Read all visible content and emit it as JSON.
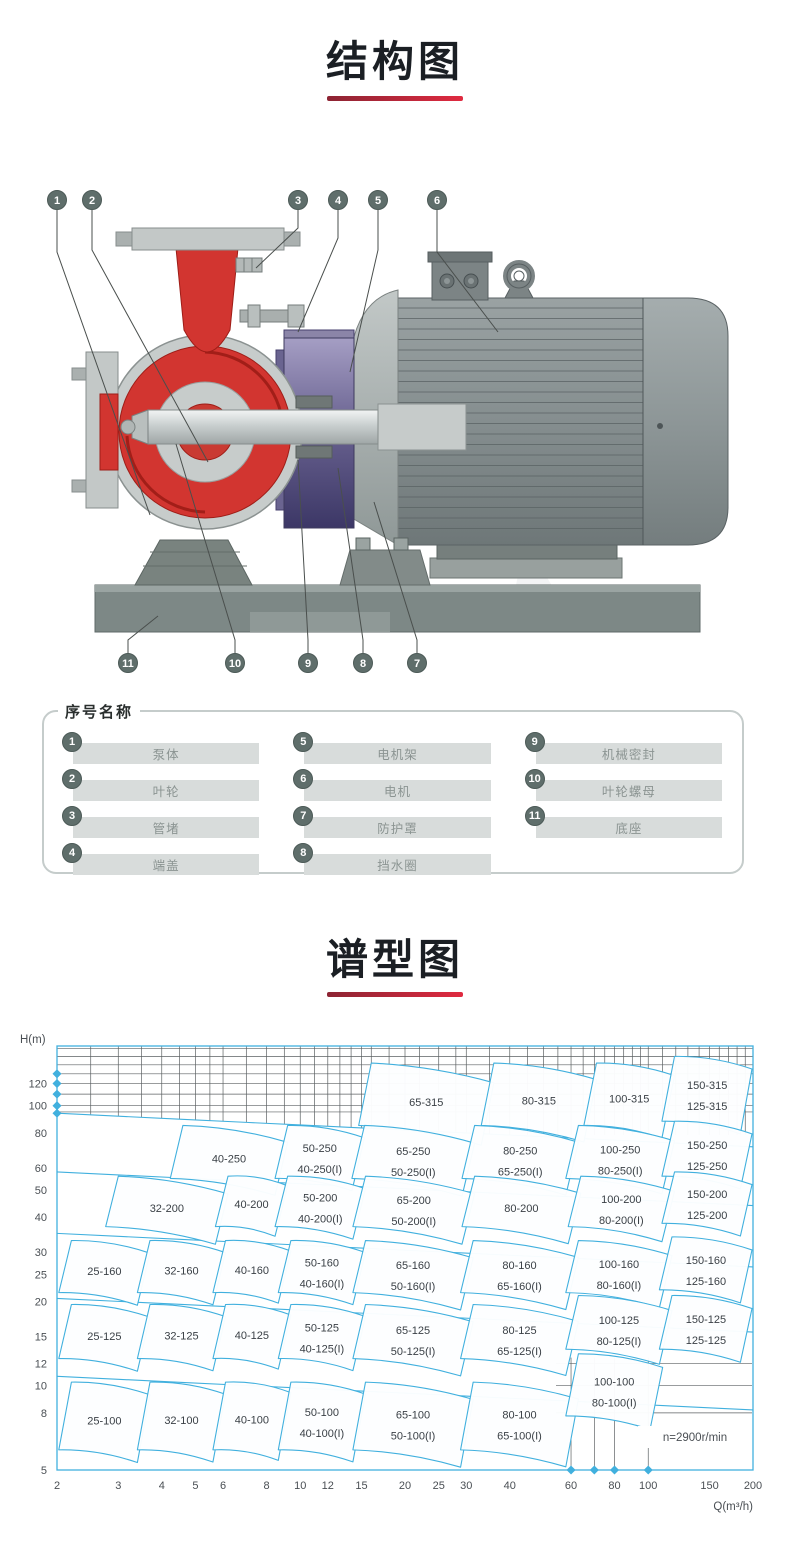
{
  "structure": {
    "title": "结构图",
    "underline_color": "#d8243c",
    "callouts_top": [
      "1",
      "2",
      "3",
      "4",
      "5",
      "6"
    ],
    "callouts_bottom": [
      "11",
      "10",
      "9",
      "8",
      "7"
    ],
    "legend": {
      "title": "序号名称",
      "items": [
        {
          "no": "1",
          "name": "泵体"
        },
        {
          "no": "2",
          "name": "叶轮"
        },
        {
          "no": "3",
          "name": "管堵"
        },
        {
          "no": "4",
          "name": "端盖"
        },
        {
          "no": "5",
          "name": "电机架"
        },
        {
          "no": "6",
          "name": "电机"
        },
        {
          "no": "7",
          "name": "防护罩"
        },
        {
          "no": "8",
          "name": "挡水圈"
        },
        {
          "no": "9",
          "name": "机械密封"
        },
        {
          "no": "10",
          "name": "叶轮螺母"
        },
        {
          "no": "11",
          "name": "底座"
        }
      ]
    }
  },
  "spectrum": {
    "title": "谱型图"
  },
  "chart_data": {
    "type": "region-map",
    "title": "谱型图",
    "x_axis_label": "Q(m³/h)",
    "y_axis_label": "H(m)",
    "x_scale": "log",
    "y_scale": "log",
    "x_range": [
      2,
      200
    ],
    "y_range": [
      5,
      165
    ],
    "x_ticks": [
      2,
      3,
      4,
      5,
      6,
      8,
      10,
      12,
      15,
      20,
      25,
      30,
      40,
      60,
      80,
      100,
      150,
      200
    ],
    "y_ticks": [
      5,
      8,
      10,
      12,
      15,
      20,
      25,
      30,
      40,
      50,
      60,
      80,
      100,
      120
    ],
    "annotation": "n=2900r/min",
    "accent_color": "#41b0de",
    "grid_color": "#5c6163",
    "regions": [
      {
        "labels": [
          "65-315"
        ],
        "q": [
          16,
          36
        ],
        "h": [
          85,
          142
        ]
      },
      {
        "labels": [
          "80-315"
        ],
        "q": [
          36,
          71
        ],
        "h": [
          85,
          142
        ]
      },
      {
        "labels": [
          "100-315"
        ],
        "q": [
          71,
          119
        ],
        "h": [
          85,
          142
        ]
      },
      {
        "labels": [
          "150-315",
          "125-315"
        ],
        "q": [
          119,
          200
        ],
        "h": [
          88,
          150
        ]
      },
      {
        "labels": [
          "40-250"
        ],
        "q": [
          4.6,
          9.2
        ],
        "h": [
          55,
          85
        ]
      },
      {
        "labels": [
          "50-250",
          "40-250(I)"
        ],
        "q": [
          9.2,
          15.3
        ],
        "h": [
          55,
          85
        ]
      },
      {
        "labels": [
          "65-250",
          "50-250(I)"
        ],
        "q": [
          15.3,
          31.7
        ],
        "h": [
          55,
          85
        ]
      },
      {
        "labels": [
          "80-250",
          "65-250(I)"
        ],
        "q": [
          31.7,
          63
        ],
        "h": [
          55,
          85
        ]
      },
      {
        "labels": [
          "100-250",
          "80-250(I)"
        ],
        "q": [
          63,
          119
        ],
        "h": [
          55,
          85
        ]
      },
      {
        "labels": [
          "150-250",
          "125-250"
        ],
        "q": [
          119,
          200
        ],
        "h": [
          56,
          88
        ]
      },
      {
        "labels": [
          "32-200"
        ],
        "q": [
          3.0,
          6.2
        ],
        "h": [
          37,
          56
        ]
      },
      {
        "labels": [
          "40-200"
        ],
        "q": [
          6.2,
          9.2
        ],
        "h": [
          37,
          56
        ]
      },
      {
        "labels": [
          "50-200",
          "40-200(I)"
        ],
        "q": [
          9.2,
          15.4
        ],
        "h": [
          37,
          56
        ]
      },
      {
        "labels": [
          "65-200",
          "50-200(I)"
        ],
        "q": [
          15.4,
          31.7
        ],
        "h": [
          37,
          56
        ]
      },
      {
        "labels": [
          "80-200"
        ],
        "q": [
          31.7,
          64
        ],
        "h": [
          37,
          56
        ]
      },
      {
        "labels": [
          "100-200",
          "80-200(I)"
        ],
        "q": [
          64,
          119
        ],
        "h": [
          37,
          56
        ]
      },
      {
        "labels": [
          "150-200",
          "125-200"
        ],
        "q": [
          119,
          200
        ],
        "h": [
          38,
          58
        ]
      },
      {
        "labels": [
          "25-160"
        ],
        "q": [
          2.2,
          3.7
        ],
        "h": [
          21.5,
          33
        ]
      },
      {
        "labels": [
          "32-160"
        ],
        "q": [
          3.7,
          6.1
        ],
        "h": [
          21.5,
          33
        ]
      },
      {
        "labels": [
          "40-160"
        ],
        "q": [
          6.1,
          9.4
        ],
        "h": [
          21.5,
          33
        ]
      },
      {
        "labels": [
          "50-160",
          "40-160(I)"
        ],
        "q": [
          9.4,
          15.4
        ],
        "h": [
          21.5,
          33
        ]
      },
      {
        "labels": [
          "65-160",
          "50-160(I)"
        ],
        "q": [
          15.4,
          31.4
        ],
        "h": [
          21.5,
          33
        ]
      },
      {
        "labels": [
          "80-160",
          "65-160(I)"
        ],
        "q": [
          31.4,
          63
        ],
        "h": [
          21.5,
          33
        ]
      },
      {
        "labels": [
          "100-160",
          "80-160(I)"
        ],
        "q": [
          63,
          117
        ],
        "h": [
          21.5,
          33
        ]
      },
      {
        "labels": [
          "150-160",
          "125-160"
        ],
        "q": [
          117,
          200
        ],
        "h": [
          22,
          34
        ]
      },
      {
        "labels": [
          "25-125"
        ],
        "q": [
          2.2,
          3.7
        ],
        "h": [
          12.5,
          19.5
        ]
      },
      {
        "labels": [
          "32-125"
        ],
        "q": [
          3.7,
          6.1
        ],
        "h": [
          12.5,
          19.5
        ]
      },
      {
        "labels": [
          "40-125"
        ],
        "q": [
          6.1,
          9.4
        ],
        "h": [
          12.5,
          19.5
        ]
      },
      {
        "labels": [
          "50-125",
          "40-125(I)"
        ],
        "q": [
          9.4,
          15.4
        ],
        "h": [
          12.5,
          19.5
        ]
      },
      {
        "labels": [
          "65-125",
          "50-125(I)"
        ],
        "q": [
          15.4,
          31.4
        ],
        "h": [
          12.5,
          19.5
        ]
      },
      {
        "labels": [
          "80-125",
          "65-125(I)"
        ],
        "q": [
          31.4,
          63
        ],
        "h": [
          12.5,
          19.5
        ]
      },
      {
        "labels": [
          "100-125",
          "80-125(I)"
        ],
        "q": [
          63,
          117
        ],
        "h": [
          13.5,
          21
        ]
      },
      {
        "labels": [
          "150-125",
          "125-125"
        ],
        "q": [
          117,
          200
        ],
        "h": [
          13.5,
          21
        ]
      },
      {
        "labels": [
          "25-100"
        ],
        "q": [
          2.2,
          3.7
        ],
        "h": [
          5.9,
          10.3
        ]
      },
      {
        "labels": [
          "32-100"
        ],
        "q": [
          3.7,
          6.1
        ],
        "h": [
          5.9,
          10.3
        ]
      },
      {
        "labels": [
          "40-100"
        ],
        "q": [
          6.1,
          9.4
        ],
        "h": [
          5.9,
          10.3
        ]
      },
      {
        "labels": [
          "50-100",
          "40-100(I)"
        ],
        "q": [
          9.4,
          15.4
        ],
        "h": [
          5.9,
          10.3
        ]
      },
      {
        "labels": [
          "65-100",
          "50-100(I)"
        ],
        "q": [
          15.4,
          31.4
        ],
        "h": [
          5.9,
          10.3
        ]
      },
      {
        "labels": [
          "80-100",
          "65-100(I)"
        ],
        "q": [
          31.4,
          63
        ],
        "h": [
          5.9,
          10.3
        ]
      },
      {
        "labels": [
          "100-100",
          "80-100(I)"
        ],
        "q": [
          63,
          110
        ],
        "h": [
          7.8,
          13
        ]
      }
    ],
    "envelope_curves_h_at_q2": [
      94,
      58,
      35,
      20.5,
      10.8
    ],
    "axis_markers": {
      "y_axis_h": [
        130,
        120,
        110,
        100,
        94
      ],
      "x_axis_q": [
        60,
        70,
        80,
        100
      ]
    }
  }
}
